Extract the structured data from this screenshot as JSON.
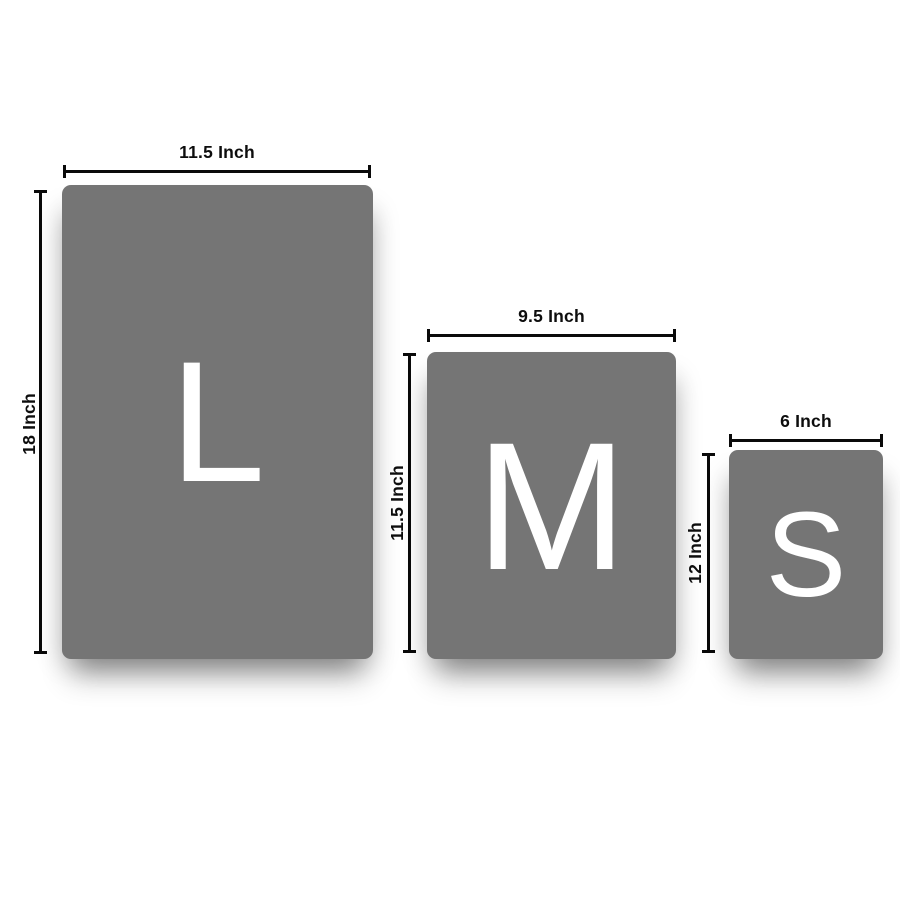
{
  "diagram_title": "size-comparison-chart",
  "colors": {
    "background": "#ffffff",
    "card": "#757575",
    "letter": "#ffffff",
    "dimension_line": "#0a0a0a",
    "label_text": "#0d0d0d"
  },
  "cards": [
    {
      "size_code": "L",
      "width_label": "11.5 Inch",
      "height_label": "18 Inch",
      "width_in": 11.5,
      "height_in": 18
    },
    {
      "size_code": "M",
      "width_label": "9.5 Inch",
      "height_label": "11.5 Inch",
      "width_in": 9.5,
      "height_in": 11.5
    },
    {
      "size_code": "S",
      "width_label": "6 Inch",
      "height_label": "12 Inch",
      "width_in": 6,
      "height_in": 12
    }
  ]
}
